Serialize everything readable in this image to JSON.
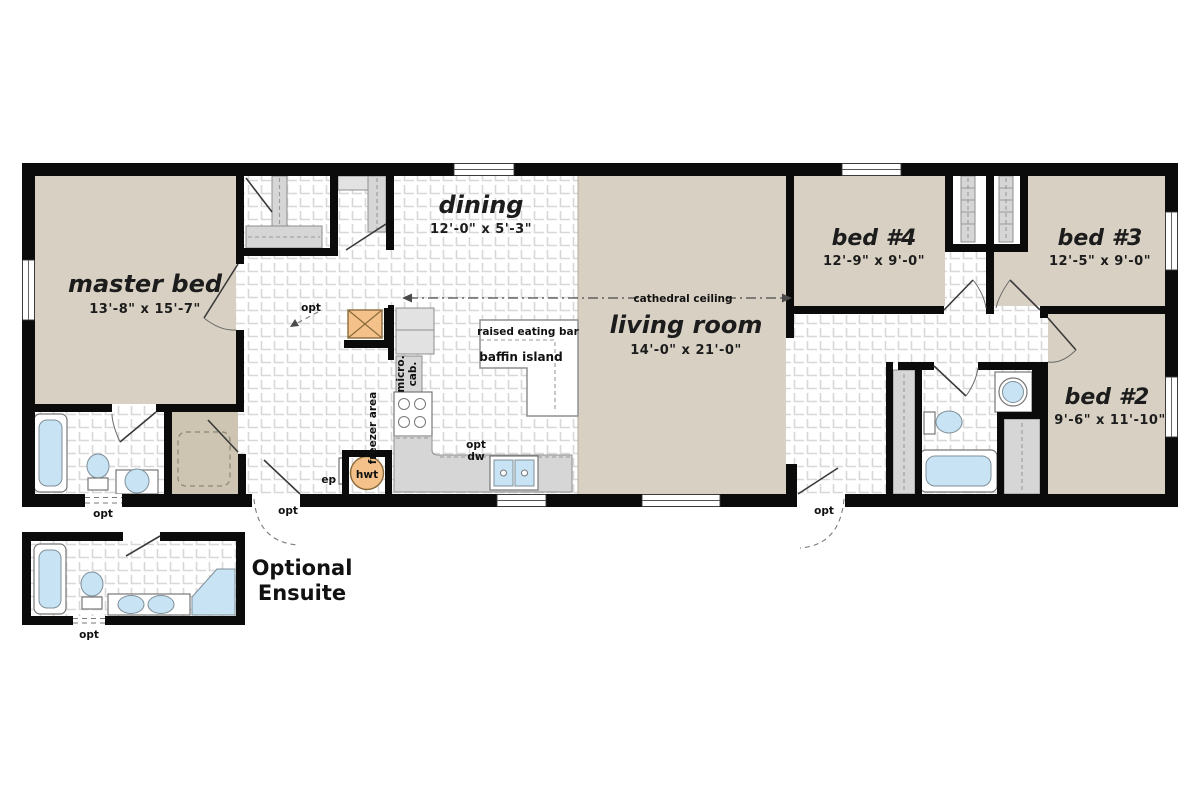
{
  "plan": {
    "rooms": {
      "master_bed": {
        "name": "master bed",
        "dims": "13'-8\" x 15'-7\""
      },
      "dining": {
        "name": "dining",
        "dims": "12'-0\" x 5'-3\""
      },
      "living_room": {
        "name": "living room",
        "dims": "14'-0\" x 21'-0\""
      },
      "bed_4": {
        "name": "bed #4",
        "dims": "12'-9\" x 9'-0\""
      },
      "bed_3": {
        "name": "bed #3",
        "dims": "12'-5\" x 9'-0\""
      },
      "bed_2": {
        "name": "bed #2",
        "dims": "9'-6\" x 11'-10\""
      }
    },
    "annotations": {
      "cathedral_ceiling": "cathedral ceiling",
      "raised_eating_bar": "raised eating bar",
      "baffin_island": "baffin island",
      "micro_line1": "micro.",
      "micro_line2": "cab.",
      "freezer_area": "freezer area",
      "opt": "opt",
      "dw": "dw",
      "ep": "ep",
      "hwt": "hwt"
    },
    "ensuite": {
      "title_line1": "Optional",
      "title_line2": "Ensuite"
    },
    "colors": {
      "room_fill": "#d8d1c3",
      "entry_fill": "#cec4b2",
      "wall": "#0b0b0b",
      "tile_line": "#d8d8d8",
      "cabinet_gray": "#d6d6d6",
      "fixture_blue": "#c8e4f4",
      "accent_orange": "#f3c189",
      "text": "#1c1c1c"
    }
  }
}
